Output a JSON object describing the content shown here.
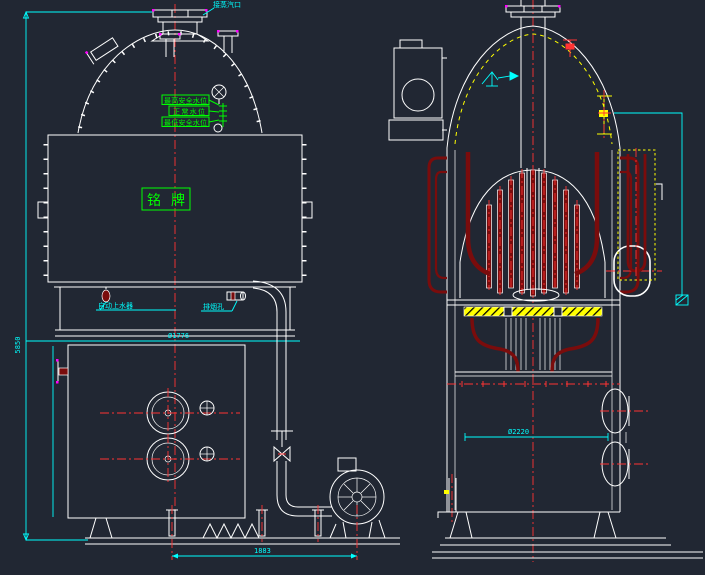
{
  "colors": {
    "background": "#212733",
    "outline": "#ffffff",
    "centerline": "#ff3333",
    "dimension": "#00ffff",
    "annotation_green": "#00ff00",
    "tube_dark_red": "#7a0c0c",
    "highlight_yellow": "#ffff00",
    "fitting_magenta": "#ff00ff"
  },
  "left_view": {
    "steam_outlet_label": "接蒸汽口",
    "water_level_labels": [
      "最高安全水位",
      "正常水位",
      "最低安全水位"
    ],
    "nameplate_label": "铭牌",
    "feeder_label": "自动上水器",
    "inspection_hole_label": "排烟孔",
    "overall_height_dim": "5850",
    "shell_diameter_dim": "Ø1776",
    "base_width_dim": "1883"
  },
  "right_view": {
    "shell_diameter_dim": "Ø2220"
  }
}
